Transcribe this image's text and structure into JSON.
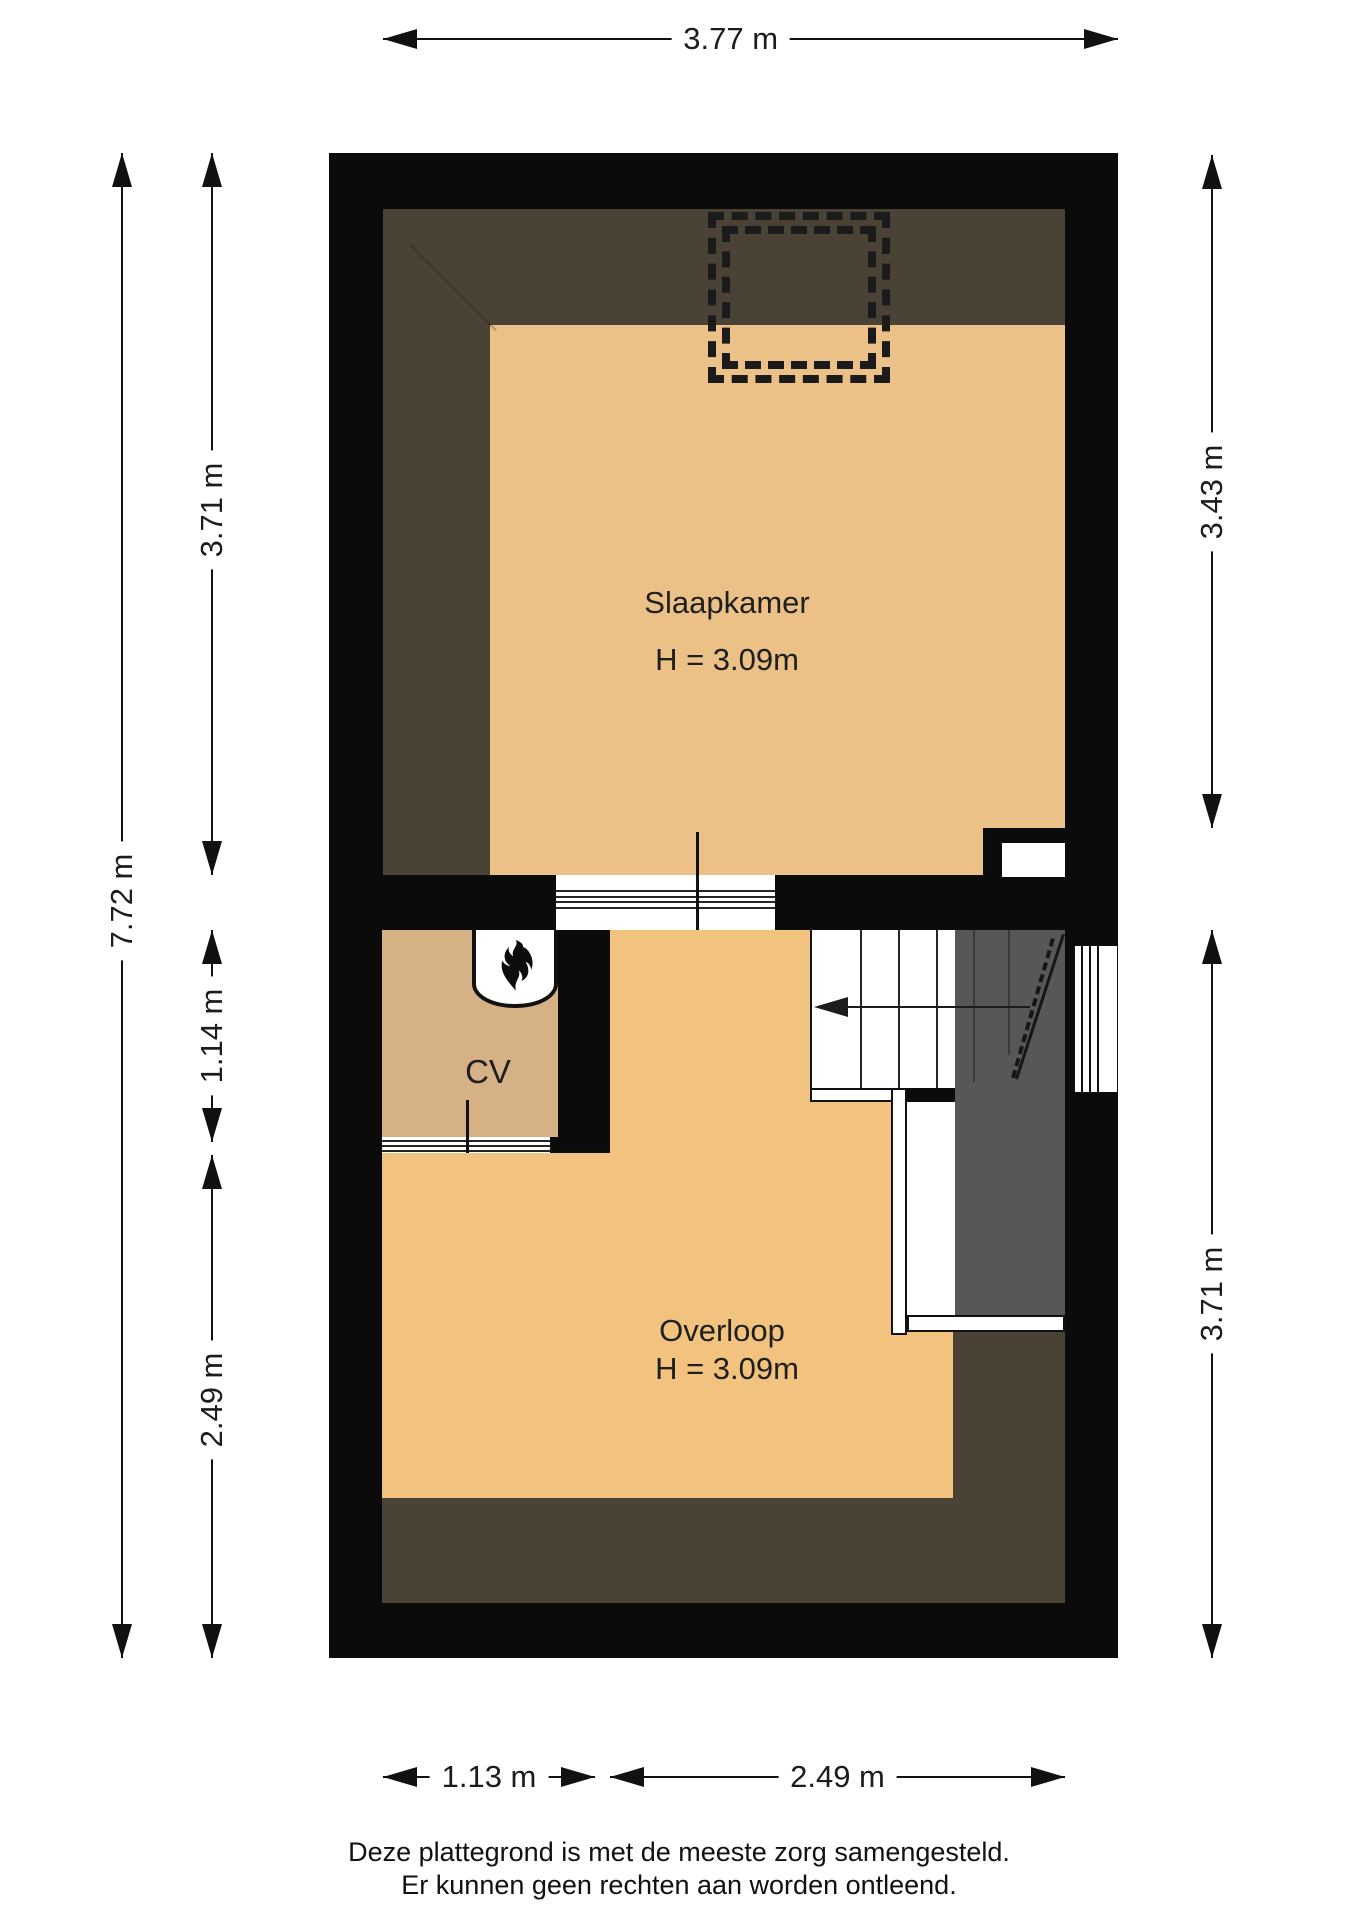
{
  "plan": {
    "rooms": {
      "slaapkamer": {
        "label": "Slaapkamer",
        "height_label": "H = 3.09m"
      },
      "cv": {
        "label": "CV"
      },
      "overloop": {
        "label": "Overloop",
        "height_label": "H = 3.09m"
      }
    },
    "dimensions": {
      "top": "3.77 m",
      "left_outer": "7.72 m",
      "left_inner": [
        "3.71 m",
        "1.14 m",
        "2.49 m"
      ],
      "right": [
        "3.43 m",
        "3.71 m"
      ],
      "bottom": [
        "1.13 m",
        "2.49 m"
      ]
    },
    "icons": {
      "boiler_flame": "flame-icon",
      "stair_direction": "arrow-left-icon"
    },
    "colors": {
      "wall": "#0b0b0b",
      "floor_slaapkamer": "#EBC187",
      "floor_overloop": "#F2C37E",
      "floor_cv": "#D6B185",
      "low_headroom_zone": "#4A4234",
      "stair_void": "#575757"
    },
    "footer": {
      "line1": "Deze plattegrond is met de meeste zorg samengesteld.",
      "line2": "Er kunnen geen rechten aan worden ontleend."
    }
  }
}
